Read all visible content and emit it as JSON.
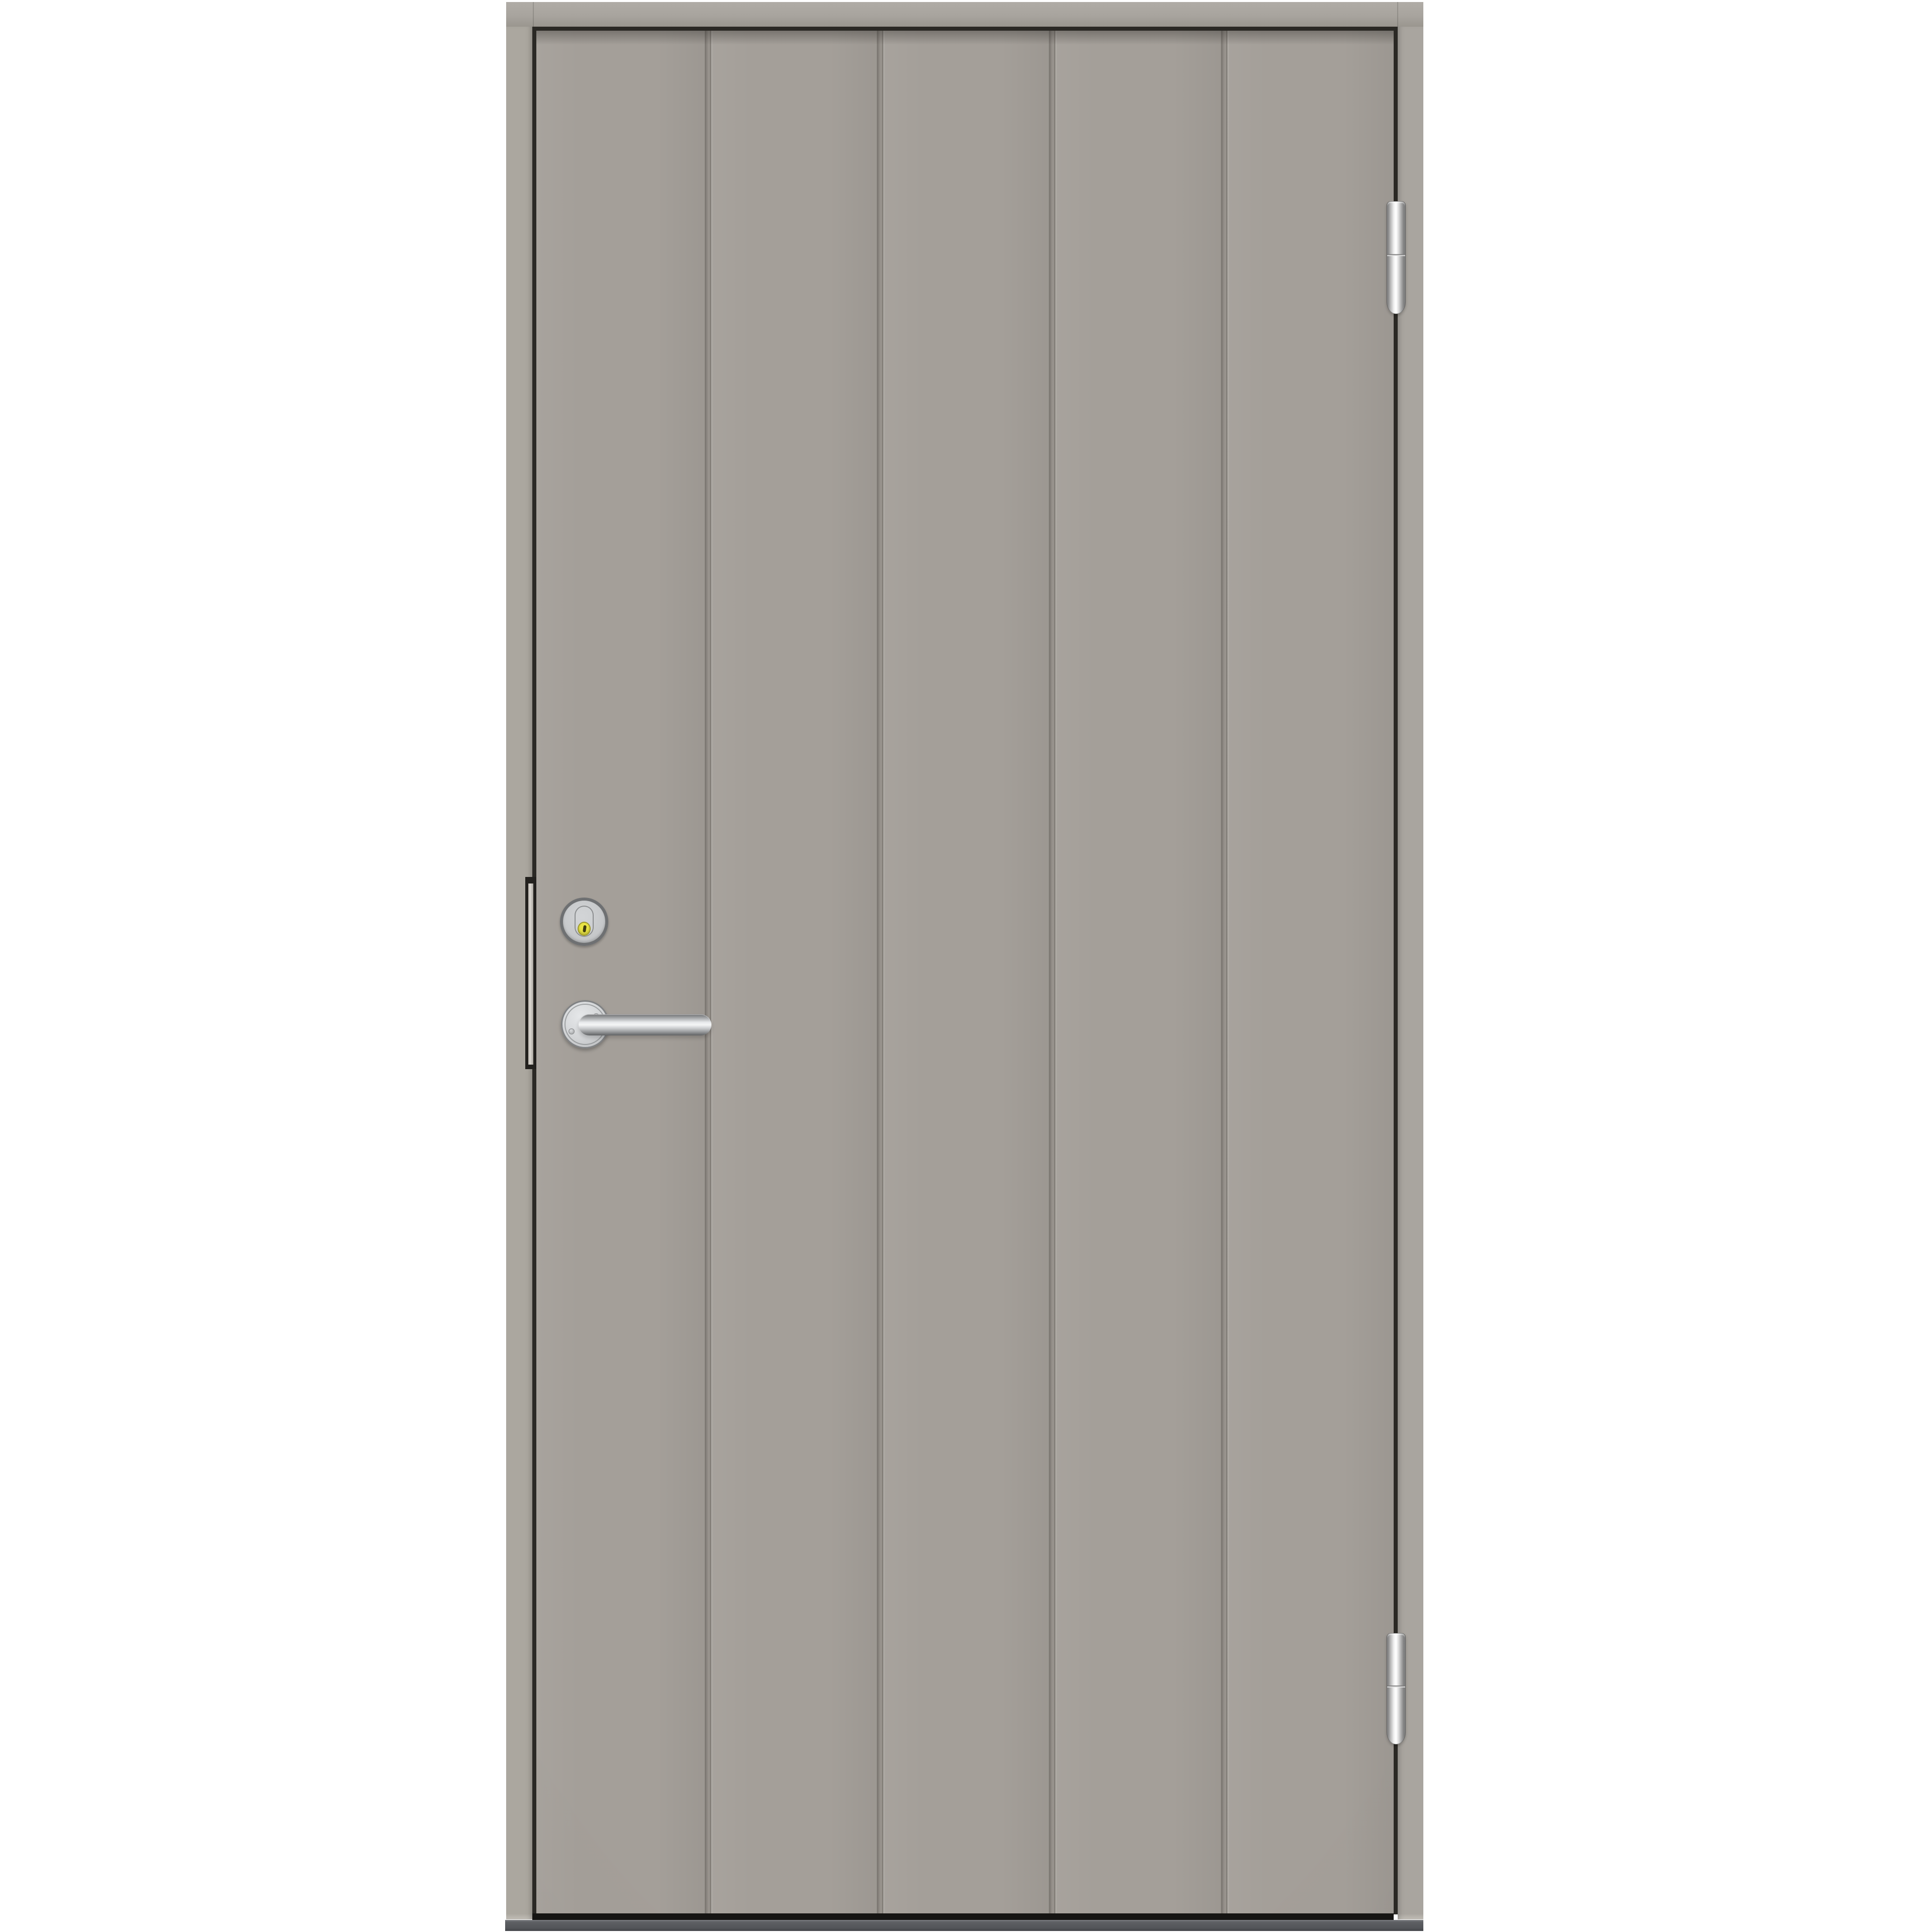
{
  "meta": {
    "type": "product-photo",
    "description": "Light greige smooth exterior front door with five vertical plank panels, silver hardware, white studio background"
  },
  "background": {
    "color": "#ffffff"
  },
  "door": {
    "slab_color": "#a49f99",
    "frame_color": "#aba79f",
    "panel_count": 5,
    "groove_count": 4,
    "hinge_side": "right",
    "handle_side": "left"
  },
  "hardware": {
    "hinges": {
      "count": 2,
      "finish_color": "#d9d9d9",
      "style": "barrel pivot hinge"
    },
    "cylinder_lock": {
      "ring_color": "#6e7072",
      "face_color": "#c9cbcd",
      "escutcheon_shape": "oval",
      "keyhole_cover_color": "#e9e445"
    },
    "lever_handle": {
      "finish_color": "#c9cbcd",
      "rose_shape": "round",
      "screw_count": 2,
      "style": "return lever"
    },
    "edge_faceplate_color": "#cfccc5"
  },
  "threshold": {
    "color": "#54565a"
  },
  "reveal_gap_color": "#2b2925"
}
